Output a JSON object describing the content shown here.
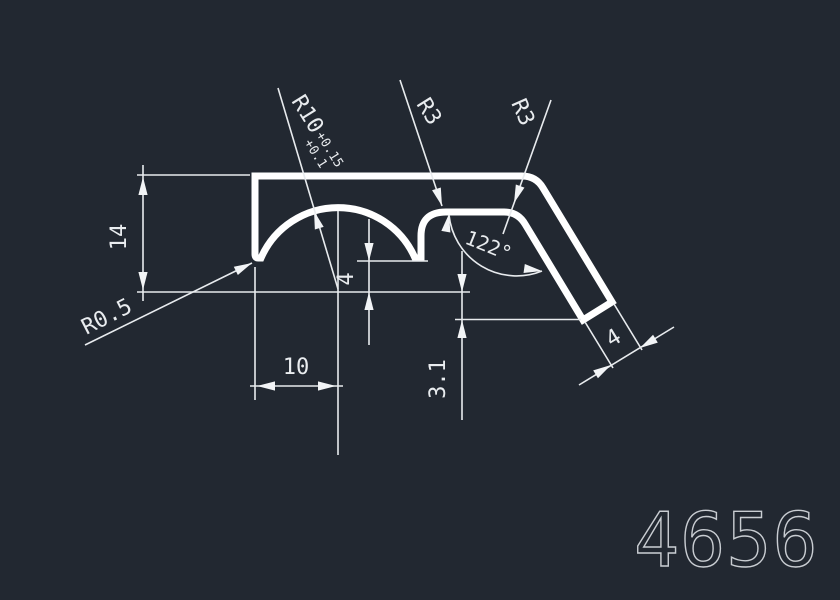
{
  "drawing": {
    "part_number": "4656",
    "colors": {
      "background": "#222831",
      "outline": "#ffffff",
      "dimension_lines": "#e8ebee",
      "part_number_text": "#c9cdd2"
    },
    "labels": {
      "radius_dome": "R10",
      "radius_dome_tol_upper": "+0.15",
      "radius_dome_tol_lower": "+0.1",
      "radius_inner_corner": "R3",
      "radius_outer_corner": "R3",
      "radius_left_corner": "R0.5",
      "bend_angle": "122°",
      "overall_height": "14",
      "dome_center_offset": "10",
      "notch_height": "4",
      "leg_drop": "3.1",
      "leg_thickness": "4"
    }
  }
}
